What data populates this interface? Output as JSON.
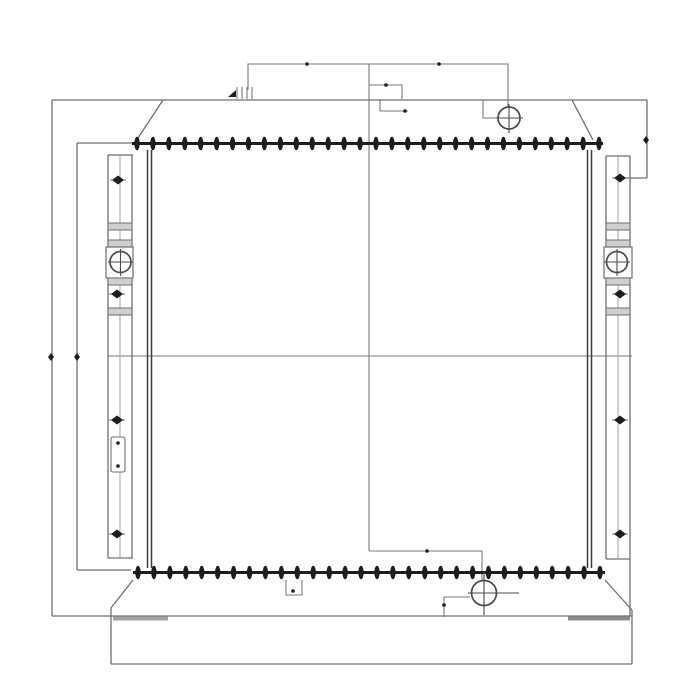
{
  "diagram": {
    "title": "radiator-assembly-line-drawing",
    "subject": "Heat exchanger / radiator front-view technical drawing",
    "background_color": "#ffffff",
    "line_color": "#6f6f6f",
    "dark_color": "#1d1d1d",
    "port_stroke_color": "#4a4a4a",
    "pad_colors": [
      "#a3a3a3",
      "#8c8c8c"
    ],
    "visible_text": [],
    "parts": [
      "outer-frame",
      "top-tank",
      "bottom-tank",
      "core",
      "top-fin-strip",
      "bottom-fin-strip",
      "left-mounting-bracket",
      "right-mounting-bracket",
      "filler-neck-port",
      "drain-port",
      "left-bracket-hole",
      "right-bracket-hole",
      "vent-fitting",
      "overflow-line",
      "drain-line"
    ]
  },
  "fin_strips": {
    "top": {
      "x_start": 137,
      "x_end": 599,
      "y": 143.5,
      "bolt_count": 30,
      "bar_x1": 132,
      "bar_x2": 603
    },
    "bottom": {
      "x_start": 138,
      "x_end": 600,
      "y": 572.5,
      "bolt_count": 30,
      "bar_x1": 133,
      "bar_x2": 605
    }
  },
  "ports": [
    {
      "name": "filler-neck-port",
      "cx": 509,
      "cy": 118,
      "r": 11,
      "vx1": 104,
      "vx2": 133,
      "hx1": 496,
      "hx2": 523
    },
    {
      "name": "drain-port",
      "cx": 484,
      "cy": 593,
      "r": 12.5,
      "vx1": 572,
      "vx2": 615,
      "hx1": 468,
      "hx2": 519
    },
    {
      "name": "left-bracket-hole",
      "cx": 120.5,
      "cy": 262,
      "r": 10.5,
      "vx1": 249,
      "vx2": 276,
      "hx1": 108,
      "hx2": 133
    },
    {
      "name": "right-bracket-hole",
      "cx": 617,
      "cy": 262,
      "r": 10.5,
      "vx1": 249,
      "vx2": 276,
      "hx1": 604,
      "hx2": 630
    }
  ],
  "diamond_markers": [
    {
      "x": 118,
      "y": 180
    },
    {
      "x": 117,
      "y": 294
    },
    {
      "x": 117,
      "y": 420
    },
    {
      "x": 117,
      "y": 534
    },
    {
      "x": 620,
      "y": 178
    },
    {
      "x": 620,
      "y": 294
    },
    {
      "x": 620,
      "y": 420
    },
    {
      "x": 620,
      "y": 534
    }
  ],
  "small_markers": [
    {
      "x": 646,
      "y": 140
    },
    {
      "x": 51,
      "y": 357
    },
    {
      "x": 77,
      "y": 357
    }
  ],
  "junction_dots": [
    {
      "x": 307,
      "y": 64
    },
    {
      "x": 439,
      "y": 64
    },
    {
      "x": 386,
      "y": 85
    },
    {
      "x": 405,
      "y": 111
    },
    {
      "x": 427,
      "y": 551
    },
    {
      "x": 444,
      "y": 605
    },
    {
      "x": 293,
      "y": 591
    },
    {
      "x": 118,
      "y": 443
    },
    {
      "x": 118,
      "y": 466
    }
  ]
}
